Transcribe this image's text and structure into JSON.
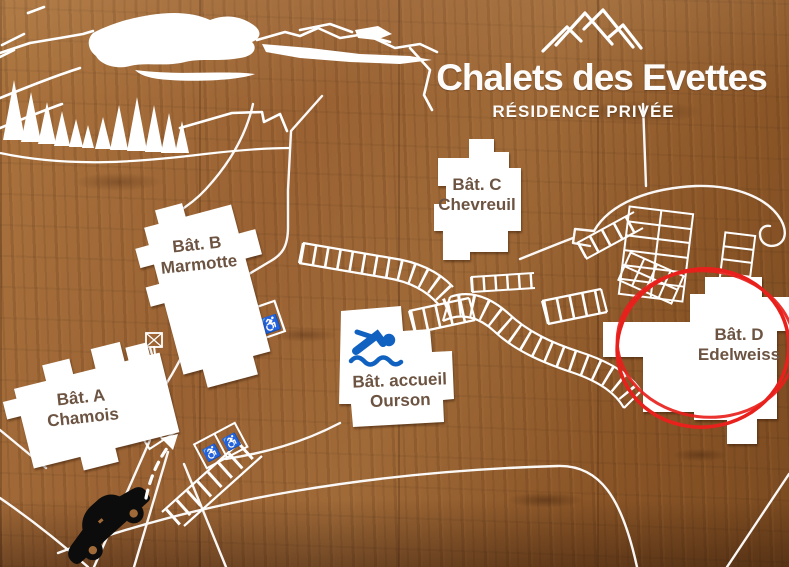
{
  "sign": {
    "title": "Chalets des Evettes",
    "subtitle": "RÉSIDENCE PRIVÉE"
  },
  "buildings": {
    "a": {
      "name": "Bât. A",
      "label": "Chamois"
    },
    "b": {
      "name": "Bât. B",
      "label": "Marmotte"
    },
    "c": {
      "name": "Bât. C",
      "label": "Chevreuil"
    },
    "accueil": {
      "name": "Bât. accueil",
      "label": "Ourson"
    },
    "d": {
      "name": "Bât. D",
      "label": "Edelweiss",
      "highlighted": true
    }
  },
  "icons": {
    "wheelchair": "♿",
    "logo": "mountain-peaks",
    "pool": "swimmer",
    "vehicle": "car"
  },
  "highlight": {
    "target": "Bât. D Edelweiss",
    "style": "hand-drawn red circle"
  },
  "colors": {
    "wood_brown": "#9a6233",
    "map_white": "#ffffff",
    "label_brown": "#6d5442",
    "highlight_red": "#e8211c",
    "pool_blue": "#1161c0",
    "car_black": "#0c0c0c"
  }
}
